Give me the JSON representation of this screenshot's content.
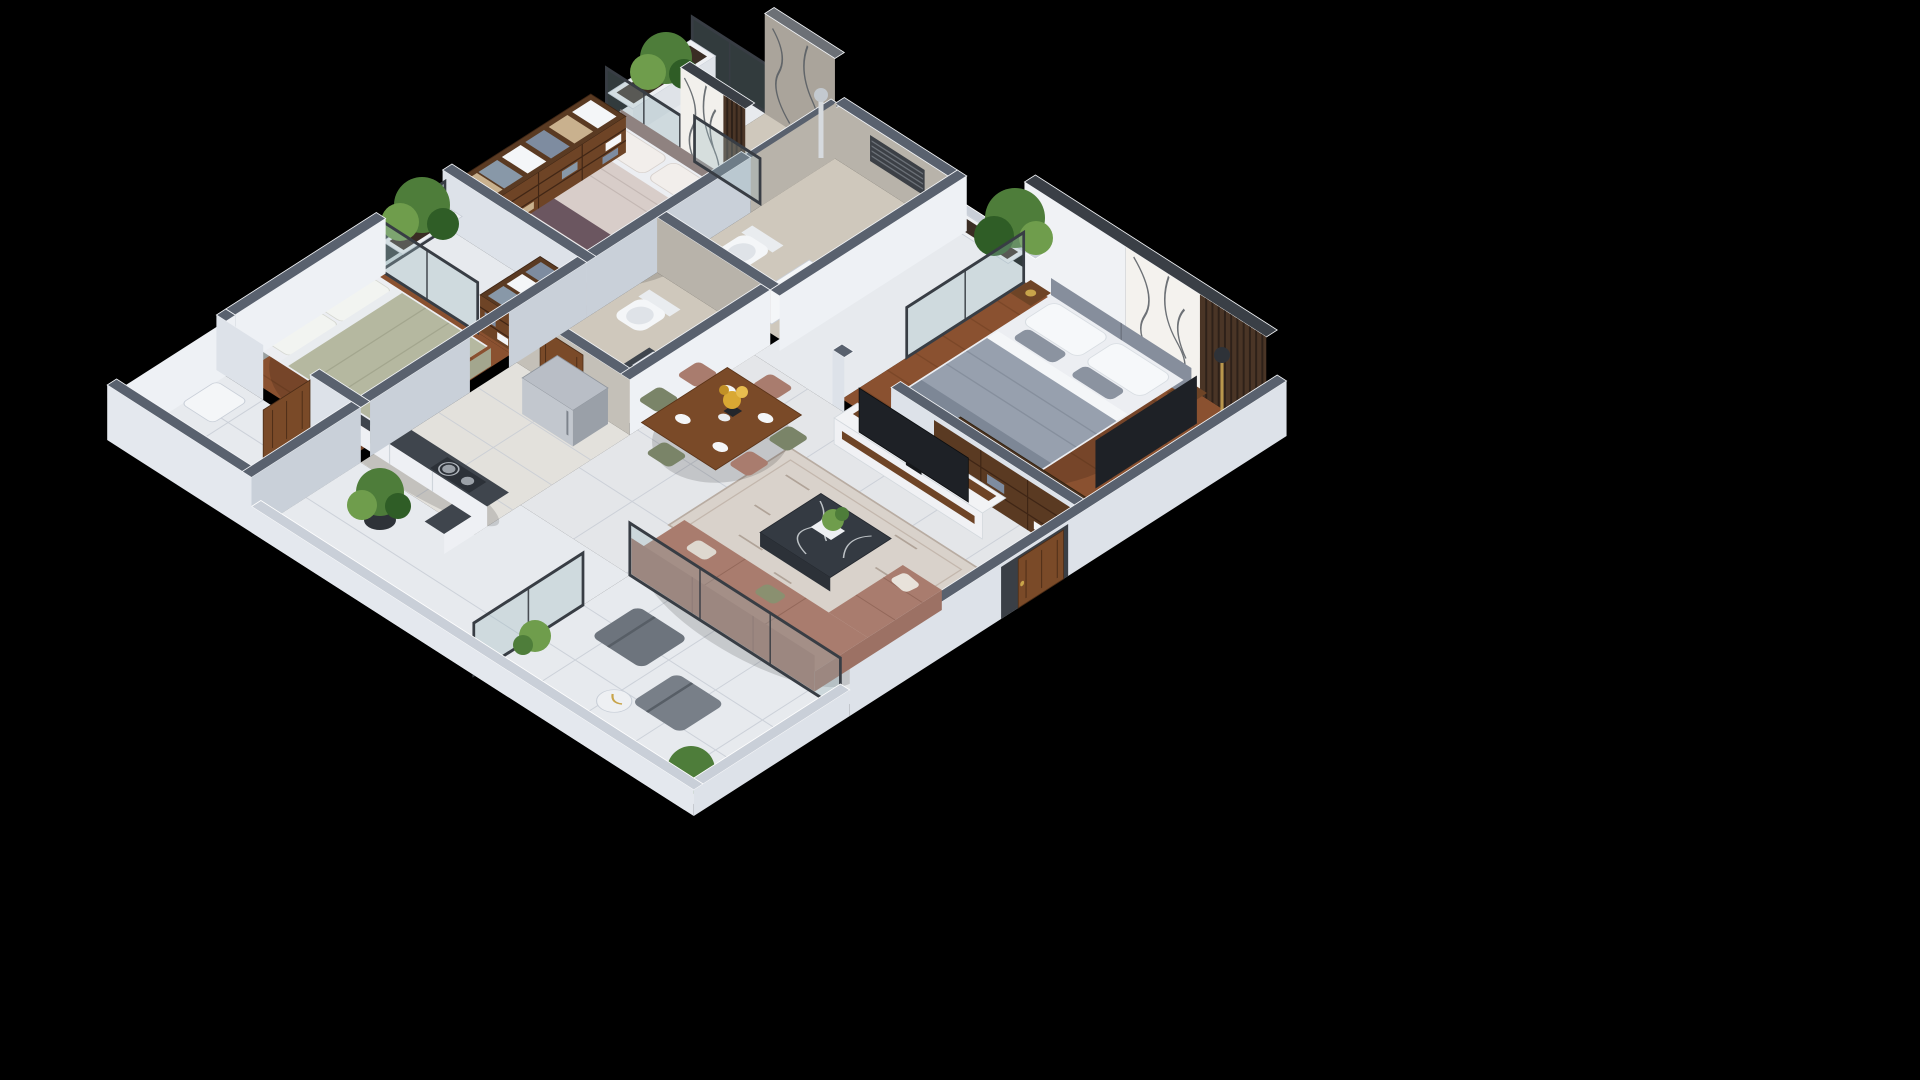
{
  "meta": {
    "type": "3d-isometric-floor-plan-render",
    "description": "Photorealistic isometric cutaway render of a 3-bedroom apartment on a black background. No text labels are visible in the image.",
    "background": "#000000"
  },
  "palette": {
    "background": "#000000",
    "wall_cap": "#59616e",
    "wall_cap_dark": "#3a3f46",
    "wall_face_light": "#eef1f5",
    "wall_face_shade": "#dde2e9",
    "wall_face_dark": "#c9d0d9",
    "marble_wall": "#aaa49b",
    "marble_wall_light": "#b8b3aa",
    "wood_floor": "#8a5130",
    "wood_floor_dark": "#6f3f23",
    "wood_furniture": "#6e4426",
    "wood_door": "#7a4a28",
    "tile_light": "#e7eaee",
    "tile_warm": "#e3e1dc",
    "tile_living": "#e4e6e9",
    "bath_floor": "#cfc8bc",
    "glass_tint": "#9bb9be",
    "granite": "#3f454d",
    "granite_dark": "#2c3138",
    "steel": "#b9bec6",
    "steel_dark": "#9aa0a8",
    "bed_white": "#eceef2",
    "master_duvet": "#97a0ae",
    "master_throw": "#7d8796",
    "headboard_gray": "#868e9c",
    "bed2_duvet": "#d8cdc9",
    "bed2_runner": "#6b5660",
    "bed3_duvet": "#b5b8a0",
    "sofa": "#a97c6e",
    "sofa_dark": "#9c7164",
    "chair_sage": "#7a8468",
    "rug": "#d9d2cb",
    "tv": "#1e2126",
    "plant": "#4e7d3a",
    "plant_light": "#6f9d4c",
    "plant_dark": "#2f5d26",
    "flower": "#d9a833",
    "gold": "#c8a44a",
    "washer": "#8fa3b8"
  },
  "scene": {
    "rooms": [
      {
        "name": "bedroom-2",
        "floor": "wood",
        "furniture": [
          "double-bed-with-mauve-runner",
          "upholstered-headboard",
          "marble-art-wall",
          "wood-slat-panel",
          "open-wardrobe-with-towels",
          "balcony-with-glass-railing",
          "planter-box"
        ]
      },
      {
        "name": "bathroom-1",
        "floor": "beige-marble",
        "furniture": [
          "wall-hung-toilet",
          "white-vanity-basin",
          "glass-shower",
          "shower-column",
          "louver-vent"
        ]
      },
      {
        "name": "bathroom-2",
        "floor": "beige-marble",
        "furniture": [
          "wall-hung-toilet",
          "granite-counter-square-basin",
          "open-wood-door"
        ]
      },
      {
        "name": "master-bedroom",
        "floor": "wood",
        "furniture": [
          "king-bed-gray-duvet",
          "gray-headboard",
          "marble-art-wall",
          "wood-slat-panel",
          "two-side-tables",
          "foot-bench",
          "open-wardrobe-with-clothes",
          "dresser-with-tv",
          "floor-lamp",
          "balcony-with-glass-railing-and-planter"
        ]
      },
      {
        "name": "living-room",
        "floor": "light-tile",
        "furniture": [
          "tv-console-with-television",
          "area-rug",
          "dark-marble-coffee-table",
          "l-shaped-terracotta-sofa",
          "glass-partition-to-balcony"
        ]
      },
      {
        "name": "dining-area",
        "floor": "light-tile",
        "furniture": [
          "wood-dining-table",
          "six-chairs",
          "place-settings",
          "yellow-flower-vase"
        ]
      },
      {
        "name": "kitchen",
        "floor": "warm-tile",
        "furniture": [
          "stainless-refrigerator",
          "granite-l-counter",
          "gas-hob-with-pan",
          "washing-machine"
        ]
      },
      {
        "name": "bedroom-3",
        "floor": "wood",
        "furniture": [
          "double-bed-sage-duvet",
          "headboard",
          "open-wardrobe-with-towels",
          "balcony-with-glass-railing",
          "planter-box"
        ]
      },
      {
        "name": "utility-room",
        "floor": "white-tile",
        "furniture": [
          "open-wood-door",
          "white-fixture"
        ]
      },
      {
        "name": "rear-balcony",
        "floor": "light-tile",
        "furniture": [
          "large-potted-plant",
          "shrub",
          "glass-partition"
        ]
      },
      {
        "name": "living-balcony",
        "floor": "light-tile",
        "furniture": [
          "two-gray-lounge-chairs",
          "round-side-table",
          "corner-plants",
          "glass-parapet"
        ]
      },
      {
        "name": "entrance",
        "floor": "-",
        "furniture": [
          "wood-entry-door-ajar",
          "dark-door-frame"
        ]
      }
    ]
  }
}
